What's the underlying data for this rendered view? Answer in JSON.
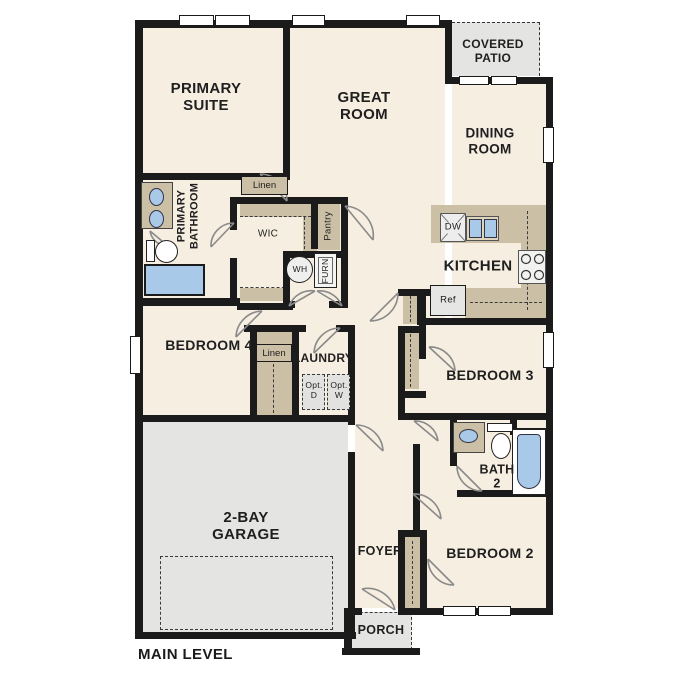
{
  "plan_title": "MAIN LEVEL",
  "rooms": {
    "primary_suite": "PRIMARY\nSUITE",
    "great_room": "GREAT\nROOM",
    "covered_patio": "COVERED\nPATIO",
    "dining_room": "DINING\nROOM",
    "kitchen": "KITCHEN",
    "primary_bathroom": "PRIMARY\nBATHROOM",
    "wic": "WIC",
    "bedroom_4": "BEDROOM 4",
    "laundry": "LAUNDRY",
    "bedroom_3": "BEDROOM 3",
    "garage": "2-BAY\nGARAGE",
    "foyer": "FOYER",
    "bath_2": "BATH\n2",
    "bedroom_2": "BEDROOM 2",
    "porch": "PORCH"
  },
  "closets": {
    "linen_bathroom": "Linen",
    "linen_hall": "Linen",
    "pantry": "Pantry"
  },
  "fixtures": {
    "water_heater": "WH",
    "furnace": "FURN",
    "refrigerator": "Ref",
    "dishwasher": "DW",
    "optional_dryer": "Opt.\nD",
    "optional_washer": "Opt.\nW"
  },
  "colors": {
    "floor": "#f6eee1",
    "wall": "#1b1b1b",
    "cabinet_tan": "#cbbfa6",
    "concrete_grey": "#e4e4e2",
    "fixture_blue": "#a9c9e9"
  }
}
